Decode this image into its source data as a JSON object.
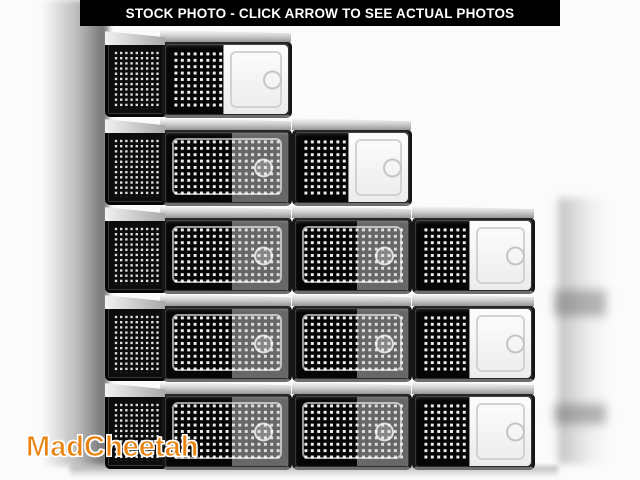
{
  "banner": {
    "text": "STOCK PHOTO - CLICK ARROW TO SEE ACTUAL PHOTOS",
    "background": "#000000",
    "color": "#ffffff"
  },
  "watermark": {
    "text": "MadCheetah",
    "color": "#e8820c",
    "outline": "#ffffff"
  },
  "scene": {
    "description": "Clear stackable plastic shoe storage boxes with black perforated panels and drop-front doors, stacked in a descending staircase of 5, 4 and 3 boxes",
    "row_top": 30,
    "row_height": 88,
    "columns": [
      {
        "name": "left",
        "x": 105,
        "width": 187,
        "side_panel": true,
        "boxes": [
          {
            "row": 0,
            "door": "bright"
          },
          {
            "row": 1,
            "door": "clear"
          },
          {
            "row": 2,
            "door": "clear"
          },
          {
            "row": 3,
            "door": "clear"
          },
          {
            "row": 4,
            "door": "clear"
          }
        ]
      },
      {
        "name": "middle",
        "x": 292,
        "width": 120,
        "side_panel": false,
        "boxes": [
          {
            "row": 1,
            "door": "bright"
          },
          {
            "row": 2,
            "door": "clear"
          },
          {
            "row": 3,
            "door": "clear"
          },
          {
            "row": 4,
            "door": "clear"
          }
        ]
      },
      {
        "name": "right",
        "x": 412,
        "width": 123,
        "side_panel": false,
        "boxes": [
          {
            "row": 2,
            "door": "bright"
          },
          {
            "row": 3,
            "door": "bright"
          },
          {
            "row": 4,
            "door": "bright"
          }
        ]
      }
    ],
    "colors": {
      "background": "#fbfbfb",
      "box_frame": "#161616",
      "box_interior": "#060606",
      "perforation": "#ffffff",
      "top_face": "#c9c9c9"
    }
  }
}
